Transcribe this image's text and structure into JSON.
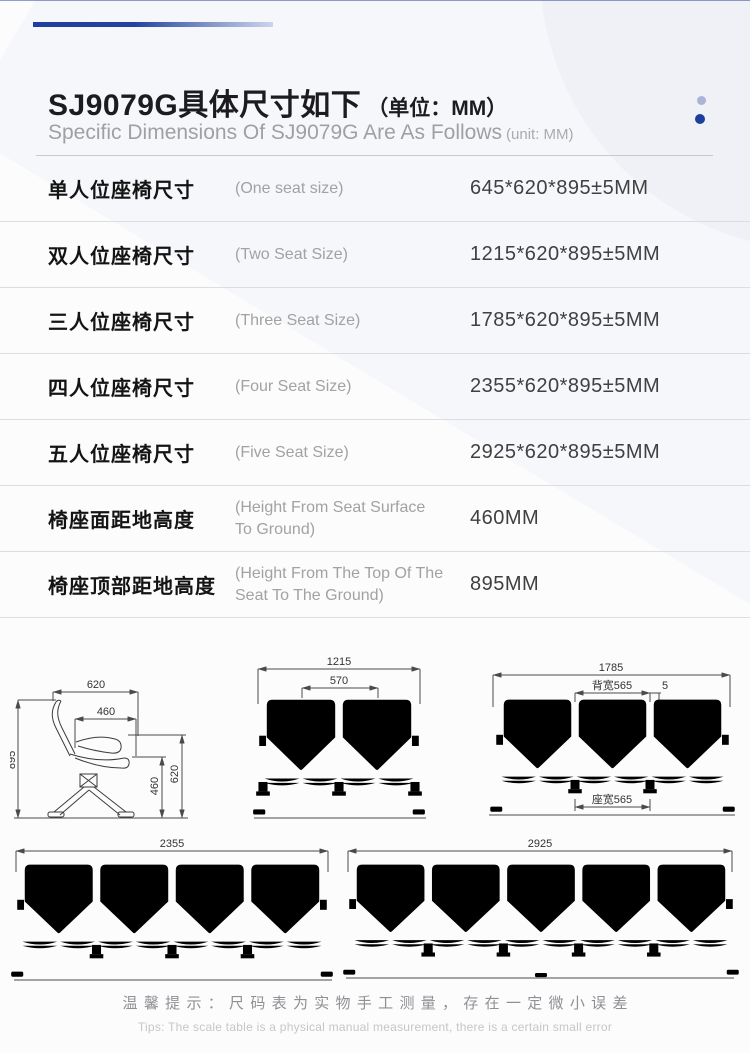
{
  "header": {
    "title_cn": "SJ9079G具体尺寸如下",
    "title_unit": "（单位：MM）",
    "subtitle_en": "Specific Dimensions Of SJ9079G Are As Follows",
    "subtitle_unit": "(unit: MM)"
  },
  "accent_colors": {
    "navy": "#1d3f9c",
    "light_blue": "#a9b4d6"
  },
  "spec_table": {
    "rows": [
      {
        "label_cn": "单人位座椅尺寸",
        "label_en": "(One seat size)",
        "value": "645*620*895±5MM"
      },
      {
        "label_cn": "双人位座椅尺寸",
        "label_en": "(Two Seat Size)",
        "value": "1215*620*895±5MM"
      },
      {
        "label_cn": "三人位座椅尺寸",
        "label_en": "(Three Seat Size)",
        "value": "1785*620*895±5MM"
      },
      {
        "label_cn": "四人位座椅尺寸",
        "label_en": "(Four Seat Size)",
        "value": "2355*620*895±5MM"
      },
      {
        "label_cn": "五人位座椅尺寸",
        "label_en": "(Five Seat Size)",
        "value": "2925*620*895±5MM"
      },
      {
        "label_cn": "椅座面距地高度",
        "label_en": "(Height From Seat Surface To Ground)",
        "value": "460MM"
      },
      {
        "label_cn": "椅座顶部距地高度",
        "label_en": "(Height From The Top Of The Seat To The Ground)",
        "value": "895MM"
      }
    ]
  },
  "drawings": {
    "side": {
      "w620": "620",
      "w460": "460",
      "h895": "895",
      "h460": "460",
      "h620": "620"
    },
    "two": {
      "total": "1215",
      "seat": "570"
    },
    "three": {
      "total": "1785",
      "back": "背宽565",
      "gap": "5",
      "seat": "座宽565"
    },
    "four": {
      "total": "2355"
    },
    "five": {
      "total": "2925"
    }
  },
  "footer": {
    "tip_cn": "温馨提示：尺码表为实物手工测量，存在一定微小误差",
    "tip_en": "Tips: The scale table is a physical manual measurement, there is a certain small error"
  }
}
